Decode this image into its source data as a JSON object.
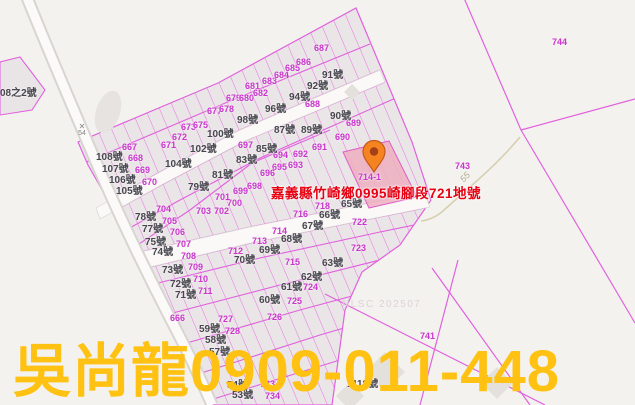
{
  "map": {
    "address_label": {
      "text": "嘉義縣竹崎鄉0995崎腳段721地號",
      "color": "#e60012"
    },
    "contact_label": {
      "text": "吳尚龍0909-011-448",
      "color": "#ffc112"
    },
    "watermark": {
      "text": "NLSC 202507"
    },
    "road_label": {
      "text": "55"
    },
    "benchmark_label": {
      "text": "54"
    },
    "highlighted_parcel": {
      "lot": "714-1"
    },
    "colors": {
      "parcel_line": "#e061dd",
      "lot_text": "#c935cd",
      "house_text": "#46464e",
      "highlight_fill": "#eeafbe",
      "road_fill": "#faf9f7",
      "pin_fill": "#f5831f"
    },
    "lot_labels": [
      {
        "t": "667",
        "x": 122,
        "y": 142
      },
      {
        "t": "668",
        "x": 128,
        "y": 153
      },
      {
        "t": "669",
        "x": 135,
        "y": 165
      },
      {
        "t": "670",
        "x": 142,
        "y": 177
      },
      {
        "t": "671",
        "x": 161,
        "y": 140
      },
      {
        "t": "672",
        "x": 172,
        "y": 132
      },
      {
        "t": "673",
        "x": 181,
        "y": 122
      },
      {
        "t": "675",
        "x": 193,
        "y": 120
      },
      {
        "t": "677",
        "x": 207,
        "y": 106
      },
      {
        "t": "678",
        "x": 219,
        "y": 104
      },
      {
        "t": "679",
        "x": 226,
        "y": 93
      },
      {
        "t": "680",
        "x": 239,
        "y": 93
      },
      {
        "t": "681",
        "x": 245,
        "y": 81
      },
      {
        "t": "682",
        "x": 253,
        "y": 88
      },
      {
        "t": "683",
        "x": 262,
        "y": 76
      },
      {
        "t": "684",
        "x": 274,
        "y": 70
      },
      {
        "t": "685",
        "x": 285,
        "y": 63
      },
      {
        "t": "686",
        "x": 296,
        "y": 57
      },
      {
        "t": "687",
        "x": 314,
        "y": 43
      },
      {
        "t": "688",
        "x": 305,
        "y": 99
      },
      {
        "t": "689",
        "x": 346,
        "y": 118
      },
      {
        "t": "690",
        "x": 335,
        "y": 132
      },
      {
        "t": "691",
        "x": 312,
        "y": 142
      },
      {
        "t": "692",
        "x": 293,
        "y": 149
      },
      {
        "t": "693",
        "x": 288,
        "y": 160
      },
      {
        "t": "694",
        "x": 273,
        "y": 150
      },
      {
        "t": "695",
        "x": 272,
        "y": 162
      },
      {
        "t": "696",
        "x": 260,
        "y": 168
      },
      {
        "t": "697",
        "x": 238,
        "y": 140
      },
      {
        "t": "698",
        "x": 247,
        "y": 181
      },
      {
        "t": "699",
        "x": 233,
        "y": 186
      },
      {
        "t": "700",
        "x": 227,
        "y": 198
      },
      {
        "t": "701",
        "x": 215,
        "y": 192
      },
      {
        "t": "702",
        "x": 214,
        "y": 206
      },
      {
        "t": "703",
        "x": 196,
        "y": 206
      },
      {
        "t": "704",
        "x": 156,
        "y": 204
      },
      {
        "t": "705",
        "x": 162,
        "y": 216
      },
      {
        "t": "706",
        "x": 170,
        "y": 227
      },
      {
        "t": "707",
        "x": 176,
        "y": 239
      },
      {
        "t": "708",
        "x": 181,
        "y": 251
      },
      {
        "t": "709",
        "x": 188,
        "y": 262
      },
      {
        "t": "710",
        "x": 193,
        "y": 274
      },
      {
        "t": "711",
        "x": 198,
        "y": 286
      },
      {
        "t": "712",
        "x": 228,
        "y": 246
      },
      {
        "t": "713",
        "x": 252,
        "y": 236
      },
      {
        "t": "714",
        "x": 272,
        "y": 226
      },
      {
        "t": "714-1",
        "x": 358,
        "y": 172
      },
      {
        "t": "715",
        "x": 285,
        "y": 257
      },
      {
        "t": "716",
        "x": 293,
        "y": 209
      },
      {
        "t": "718",
        "x": 315,
        "y": 201
      },
      {
        "t": "722",
        "x": 352,
        "y": 217
      },
      {
        "t": "723",
        "x": 351,
        "y": 243
      },
      {
        "t": "724",
        "x": 303,
        "y": 282
      },
      {
        "t": "725",
        "x": 287,
        "y": 296
      },
      {
        "t": "726",
        "x": 267,
        "y": 312
      },
      {
        "t": "727",
        "x": 218,
        "y": 314
      },
      {
        "t": "728",
        "x": 225,
        "y": 326
      },
      {
        "t": "733",
        "x": 260,
        "y": 379
      },
      {
        "t": "734",
        "x": 265,
        "y": 391
      },
      {
        "t": "666",
        "x": 170,
        "y": 313
      },
      {
        "t": "741",
        "x": 420,
        "y": 331
      },
      {
        "t": "743",
        "x": 455,
        "y": 161
      },
      {
        "t": "744",
        "x": 552,
        "y": 37
      }
    ],
    "house_labels": [
      {
        "t": "08之2號",
        "x": 0,
        "y": 84
      },
      {
        "t": "108號",
        "x": 96,
        "y": 148
      },
      {
        "t": "107號",
        "x": 102,
        "y": 160
      },
      {
        "t": "106號",
        "x": 109,
        "y": 171
      },
      {
        "t": "105號",
        "x": 116,
        "y": 182
      },
      {
        "t": "104號",
        "x": 165,
        "y": 155
      },
      {
        "t": "102號",
        "x": 190,
        "y": 140
      },
      {
        "t": "100號",
        "x": 207,
        "y": 125
      },
      {
        "t": "98號",
        "x": 237,
        "y": 111
      },
      {
        "t": "96號",
        "x": 265,
        "y": 100
      },
      {
        "t": "94號",
        "x": 289,
        "y": 88
      },
      {
        "t": "92號",
        "x": 307,
        "y": 77
      },
      {
        "t": "91號",
        "x": 322,
        "y": 66
      },
      {
        "t": "90號",
        "x": 330,
        "y": 107
      },
      {
        "t": "89號",
        "x": 301,
        "y": 121
      },
      {
        "t": "87號",
        "x": 274,
        "y": 121
      },
      {
        "t": "85號",
        "x": 256,
        "y": 140
      },
      {
        "t": "83號",
        "x": 236,
        "y": 151
      },
      {
        "t": "81號",
        "x": 212,
        "y": 166
      },
      {
        "t": "79號",
        "x": 188,
        "y": 178
      },
      {
        "t": "78號",
        "x": 135,
        "y": 208
      },
      {
        "t": "77號",
        "x": 142,
        "y": 220
      },
      {
        "t": "75號",
        "x": 145,
        "y": 233
      },
      {
        "t": "74號",
        "x": 152,
        "y": 243
      },
      {
        "t": "73號",
        "x": 162,
        "y": 261
      },
      {
        "t": "72號",
        "x": 170,
        "y": 275
      },
      {
        "t": "71號",
        "x": 175,
        "y": 286
      },
      {
        "t": "70號",
        "x": 234,
        "y": 251
      },
      {
        "t": "69號",
        "x": 259,
        "y": 241
      },
      {
        "t": "68號",
        "x": 281,
        "y": 230
      },
      {
        "t": "67號",
        "x": 302,
        "y": 217
      },
      {
        "t": "66號",
        "x": 319,
        "y": 206
      },
      {
        "t": "65號",
        "x": 341,
        "y": 195
      },
      {
        "t": "63號",
        "x": 322,
        "y": 254
      },
      {
        "t": "62號",
        "x": 301,
        "y": 268
      },
      {
        "t": "61號",
        "x": 281,
        "y": 278
      },
      {
        "t": "60號",
        "x": 259,
        "y": 291
      },
      {
        "t": "59號",
        "x": 199,
        "y": 320
      },
      {
        "t": "58號",
        "x": 205,
        "y": 331
      },
      {
        "t": "57號",
        "x": 209,
        "y": 343
      },
      {
        "t": "54號",
        "x": 227,
        "y": 376
      },
      {
        "t": "53號",
        "x": 232,
        "y": 386
      },
      {
        "t": "1118號",
        "x": 347,
        "y": 375
      }
    ]
  }
}
